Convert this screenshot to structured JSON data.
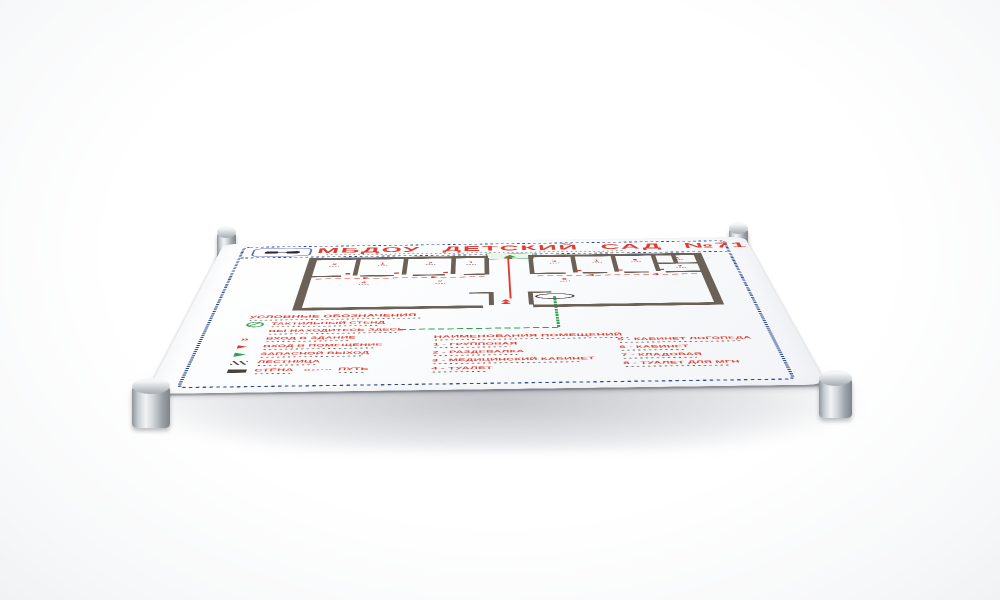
{
  "sign": {
    "title": "МБДОУ ДЕТСКИЙ САД №71",
    "header_icon": "glasses-icon",
    "legend": {
      "header": "УСЛОВНЫЕ ОБОЗНАЧЕНИЯ",
      "items": [
        {
          "icon": "tactile-stand-icon",
          "label": "ТАКТИЛЬНЫЙ СТЕНД"
        },
        {
          "icon": "you-are-here-dash-icon",
          "label": "ВЫ НАХОДИТЕСЬ ЗДЕСЬ"
        },
        {
          "icon": "building-entrance-arrow-icon",
          "label": "ВХОД В ЗДАНИЕ"
        },
        {
          "icon": "room-entrance-arrow-icon",
          "label": "ВХОД В ПОМЕЩЕНИЕ"
        },
        {
          "icon": "emergency-exit-arrow-icon",
          "label": "ЗАПАСНОЙ ВЫХОД"
        },
        {
          "icon": "stairs-icon",
          "label": "ЛЕСТНИЦА"
        },
        {
          "icon": "wall-icon",
          "label": "СТЕНА",
          "icon2": "path-dotted-icon",
          "label2": "ПУТЬ"
        }
      ]
    },
    "rooms": {
      "header": "НАИМЕНОВАНИЯ ПОМЕЩЕНИЙ",
      "col1": [
        "1 - ГРУППОВАЯ",
        "2 - РАЗДЕВАЛКА",
        "3 - МЕДИЦИНСКИЙ КАБИНЕТ",
        "4 - ТУАЛЕТ"
      ],
      "col2": [
        "5 - КАБИНЕТ ЛОГОПЕДА",
        "6 - КАБИНЕТ",
        "7 - КЛАДОВАЯ",
        "8 - ТУАЛЕТ ДЛЯ МГН"
      ]
    },
    "plan": {
      "markers": [
        "2",
        "1",
        "2",
        "1",
        "3",
        "1",
        "5",
        "6",
        "7",
        "8",
        "4",
        "2"
      ]
    },
    "colors": {
      "accent_red": "#e23b2e",
      "accent_green": "#2da14c",
      "border_navy": "#2a458f",
      "wall_brown": "#6b6156"
    }
  }
}
